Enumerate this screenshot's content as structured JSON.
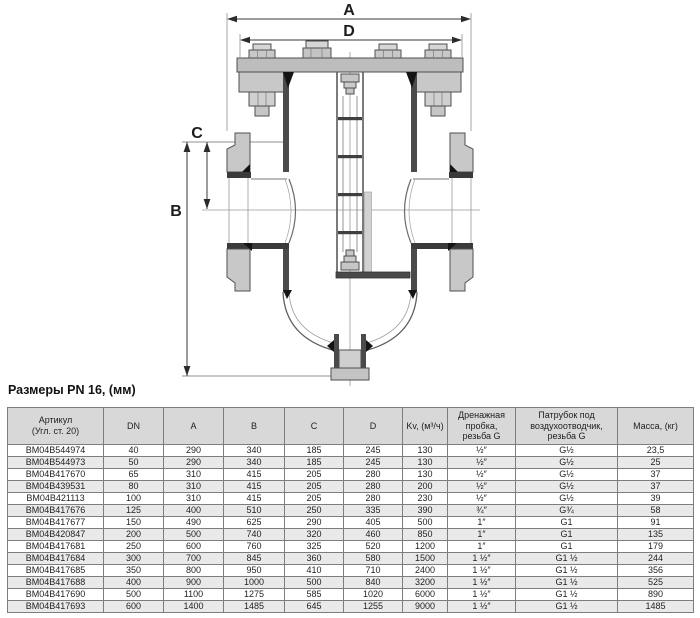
{
  "title": "Размеры PN 16, (мм)",
  "diagram": {
    "labels": {
      "a": "A",
      "d": "D",
      "b": "B",
      "c": "C"
    }
  },
  "table": {
    "headers": [
      [
        "Артикул",
        "(Угл. ст. 20)"
      ],
      [
        "DN"
      ],
      [
        "A"
      ],
      [
        "B"
      ],
      [
        "C"
      ],
      [
        "D"
      ],
      [
        "Kv, (м³/ч)"
      ],
      [
        "Дренажная",
        "пробка,",
        "резьба G"
      ],
      [
        "Патрубок под",
        "воздухоотводчик,",
        "резьба G"
      ],
      [
        "Масса, (кг)"
      ]
    ],
    "rows": [
      [
        "BM04B544974",
        "40",
        "290",
        "340",
        "185",
        "245",
        "130",
        "½″",
        "G½",
        "23,5"
      ],
      [
        "BM04B544973",
        "50",
        "290",
        "340",
        "185",
        "245",
        "130",
        "½″",
        "G½",
        "25"
      ],
      [
        "BM04B417670",
        "65",
        "310",
        "415",
        "205",
        "280",
        "130",
        "½″",
        "G½",
        "37"
      ],
      [
        "BM04B439531",
        "80",
        "310",
        "415",
        "205",
        "280",
        "200",
        "½″",
        "G½",
        "37"
      ],
      [
        "BM04B421113",
        "100",
        "310",
        "415",
        "205",
        "280",
        "230",
        "½″",
        "G½",
        "39"
      ],
      [
        "BM04B417676",
        "125",
        "400",
        "510",
        "250",
        "335",
        "390",
        "¾″",
        "G¾",
        "58"
      ],
      [
        "BM04B417677",
        "150",
        "490",
        "625",
        "290",
        "405",
        "500",
        "1″",
        "G1",
        "91"
      ],
      [
        "BM04B420847",
        "200",
        "500",
        "740",
        "320",
        "460",
        "850",
        "1″",
        "G1",
        "135"
      ],
      [
        "BM04B417681",
        "250",
        "600",
        "760",
        "325",
        "520",
        "1200",
        "1″",
        "G1",
        "179"
      ],
      [
        "BM04B417684",
        "300",
        "700",
        "845",
        "360",
        "580",
        "1500",
        "1 ½″",
        "G1 ½",
        "244"
      ],
      [
        "BM04B417685",
        "350",
        "800",
        "950",
        "410",
        "710",
        "2400",
        "1 ½″",
        "G1 ½",
        "356"
      ],
      [
        "BM04B417688",
        "400",
        "900",
        "1000",
        "500",
        "840",
        "3200",
        "1 ½″",
        "G1 ½",
        "525"
      ],
      [
        "BM04B417690",
        "500",
        "1100",
        "1275",
        "585",
        "1020",
        "6000",
        "1 ½″",
        "G1 ½",
        "890"
      ],
      [
        "BM04B417693",
        "600",
        "1400",
        "1485",
        "645",
        "1255",
        "9000",
        "1 ½″",
        "G1 ½",
        "1485"
      ]
    ]
  }
}
